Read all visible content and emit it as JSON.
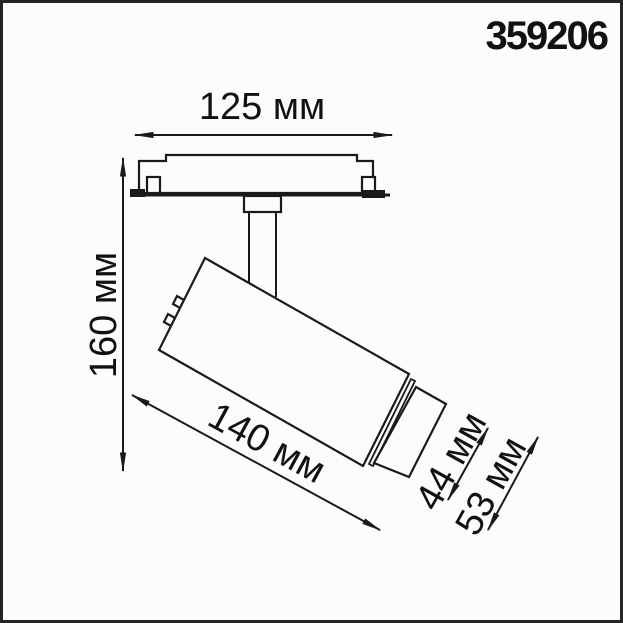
{
  "page": {
    "background": "#fcfcfc",
    "border_color": "#242424",
    "line_color": "#1a1a1a"
  },
  "product": {
    "article": "359206"
  },
  "dimensions": {
    "track_width": {
      "value": 125,
      "unit": "мм",
      "label": "125 мм"
    },
    "height": {
      "value": 160,
      "unit": "мм",
      "label": "160 мм"
    },
    "body_length": {
      "value": 140,
      "unit": "мм",
      "label": "140 мм"
    },
    "head_diameter": {
      "value": 44,
      "unit": "мм",
      "label": "44 мм"
    },
    "body_diameter": {
      "value": 53,
      "unit": "мм",
      "label": "53 мм"
    }
  }
}
